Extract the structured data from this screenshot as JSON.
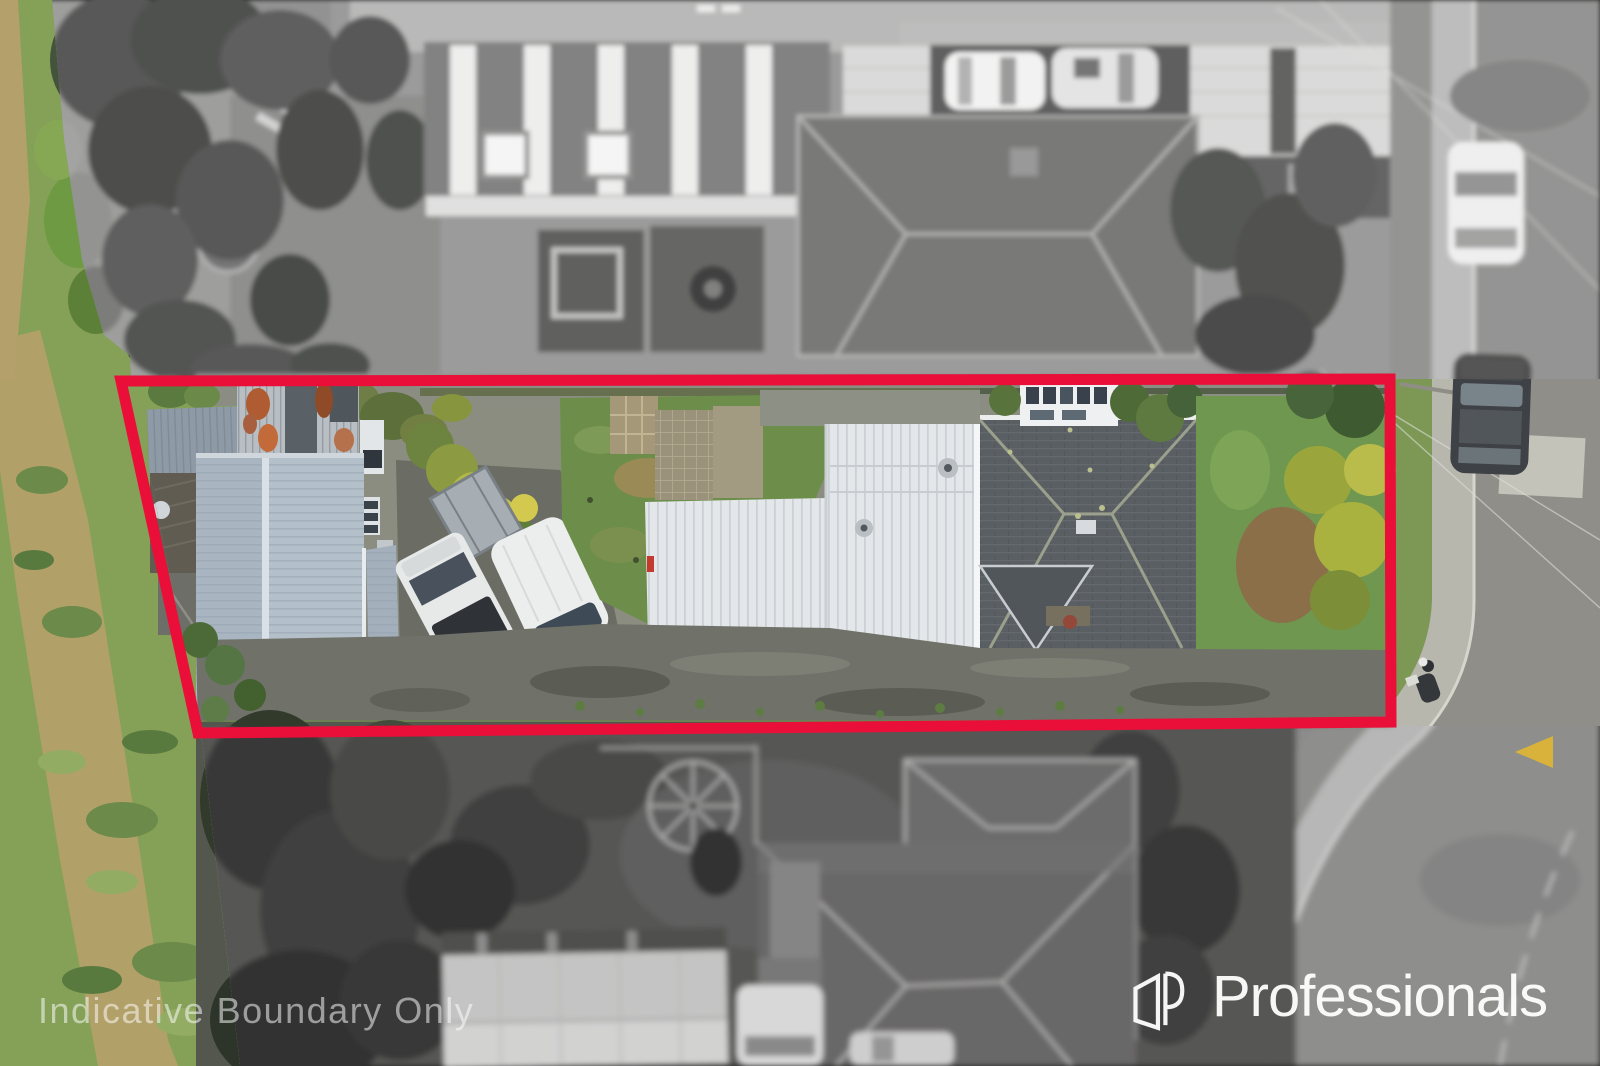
{
  "overlays": {
    "watermark_text": "Indicative Boundary Only",
    "watermark_color": "rgba(255,255,255,0.52)",
    "brand": {
      "name": "Professionals",
      "icon": "professionals-p-logo-icon",
      "color": "#FFFFFF"
    }
  },
  "boundary": {
    "color": "#E90F38"
  },
  "road_markings": {
    "arrow_color": "#D9B23C"
  }
}
